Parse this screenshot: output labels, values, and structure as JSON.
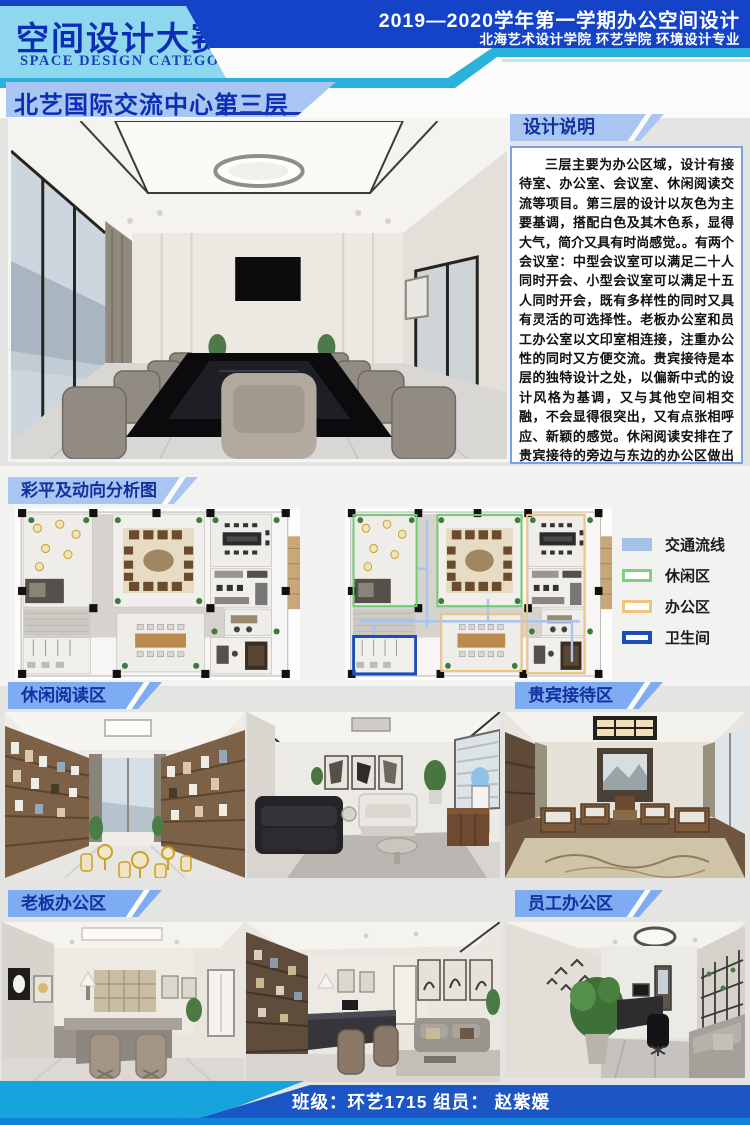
{
  "header": {
    "competition_title": "空间设计大赛",
    "competition_subtitle": "SPACE DESIGN CATEGORY",
    "term_title": "2019—2020学年第一学期办公空间设计",
    "institution": "北海艺术设计学院  环艺学院  环境设计专业",
    "project_title": "北艺国际交流中心第三层"
  },
  "design_notes": {
    "heading": "设计说明",
    "body": "三层主要为办公区域，设计有接待室、办公室、会议室、休闲阅读交流等项目。第三层的设计以灰色为主要基调，搭配白色及其木色系，显得大气，简介又具有时尚感觉。。有两个会议室：中型会议室可以满足二十人同时开会、小型会议室可以满足十五人同时开会，既有多样性的同时又具有灵活的可选择性。老板办公室和员工办公室以文印室相连接，注重办公性的同时又方便交流。贵宾接待是本层的独特设计之处，以偏新中式的设计风格为基调，又与其他空间相交融，不会显得很突出，又有点张相呼应、新颖的感觉。休闲阅读安排在了贵宾接待的旁边与东边的办公区做出区分，休闲阅读区设立了有茶水间，可以满足大家的各种需求。"
  },
  "plan_section": {
    "heading": "彩平及动向分析图",
    "legend": [
      {
        "label": "交通流线",
        "color": "#a6c1e8",
        "style": "solid"
      },
      {
        "label": "休闲区",
        "color": "#7ed07a",
        "style": "outline"
      },
      {
        "label": "办公区",
        "color": "#eec581",
        "style": "outline"
      },
      {
        "label": "卫生间",
        "color": "#1b4fb8",
        "style": "outline-thick"
      }
    ]
  },
  "sections": {
    "leisure": {
      "heading": "休闲阅读区"
    },
    "vip": {
      "heading": "贵宾接待区"
    },
    "boss": {
      "heading": "老板办公区"
    },
    "staff": {
      "heading": "员工办公区"
    }
  },
  "footer": {
    "credit": "班级：环艺1715  组员：  赵紫媛"
  },
  "colors": {
    "accent_dark_blue": "#1443c8",
    "accent_cyan": "#2ab2dc",
    "panel_cyan": "#8ed7ee",
    "banner_blue": "#a9c6f3",
    "section_header_blue": "#7dacf2",
    "title_text_blue": "#0c2eb4",
    "footer_blue": "#1c55c6"
  }
}
